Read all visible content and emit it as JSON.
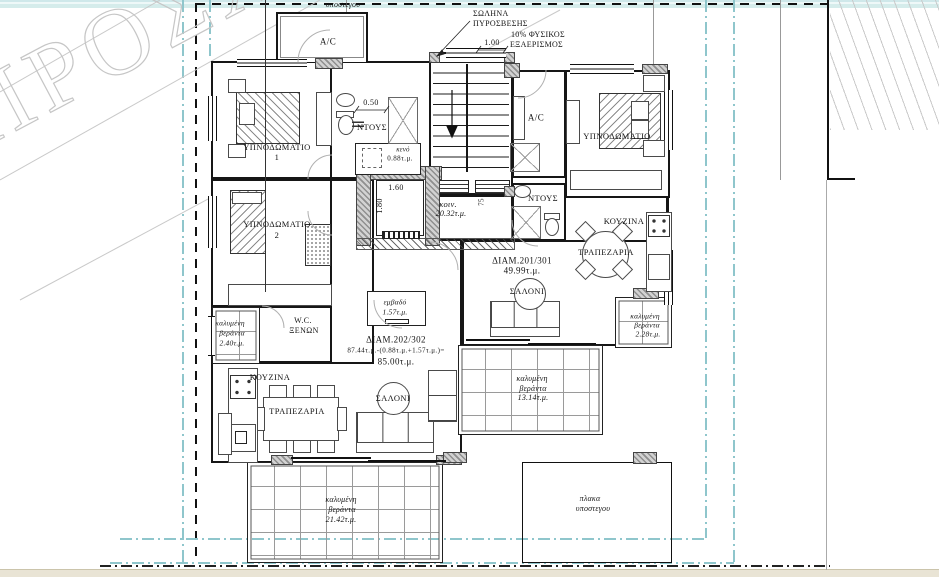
{
  "watermark": {
    "text": "ΠΡΟΣΧΕΔΙΟ"
  },
  "site": {
    "top_shelter_label": "υποστεγου",
    "shelter_slab": {
      "line1": "πλακα",
      "line2": "υποστεγου"
    },
    "fire_pipe": {
      "line1": "ΣΩΛΗΝΑ",
      "line2": "ΠΥΡΟΣΒΕΣΗΣ"
    },
    "ventilation": {
      "dim": "1.00",
      "line1": "10% ΦΥΣΙΚΟΣ",
      "line2": "ΕΞΑΕΡΙΣΜΟΣ"
    }
  },
  "common_areas": {
    "corridor": {
      "name": "κοιν.",
      "area": "20.32τ.μ.",
      "dim": "75"
    },
    "elevator": {
      "width": "1.60",
      "depth": "1.80"
    },
    "void": {
      "name": "κενό",
      "area": "0.88τ.μ."
    },
    "area_box": {
      "name": "εμβαδό",
      "area": "1.57τ.μ."
    }
  },
  "apartment_left": {
    "id": "ΔΙΑΜ.202/302",
    "area_calc": "87.44τ.μ.-(0.88τ.μ.+1.57τ.μ.)=",
    "area_total": "85.00τ.μ.",
    "rooms": {
      "ac": "A/C",
      "bedroom1": {
        "line1": "ΥΠΝΟΔΩΜΑΤΙΟ",
        "line2": "1"
      },
      "bedroom2": {
        "line1": "ΥΠΝΟΔΩΜΑΤΙΟ",
        "line2": "2"
      },
      "shower": "ΝΤΟΥΣ",
      "shower_dim": "0.50",
      "wc": {
        "line1": "W.C.",
        "line2": "ΞΕΝΩΝ"
      },
      "kitchen": "ΚΟΥΖΙΝΑ",
      "dining": "ΤΡΑΠΕΖΑΡΙΑ",
      "living": "ΣΑΛΟΝΙ"
    },
    "verandas": {
      "west": {
        "line1": "καλυμένη",
        "line2": "βεράντα",
        "area": "2.40τ.μ."
      },
      "south": {
        "line1": "καλυμένη",
        "line2": "βεράντα",
        "area": "21.42τ.μ."
      }
    }
  },
  "apartment_right": {
    "id": "ΔΙΑΜ.201/301",
    "area_total": "49.99τ.μ.",
    "rooms": {
      "ac": "A/C",
      "bedroom": "ΥΠΝΟΔΩΜΑΤΙΟ",
      "shower": "ΝΤΟΥΣ",
      "kitchen": "ΚΟΥΖΙΝΑ",
      "dining": "ΤΡΑΠΕΖΑΡΙΑ",
      "living": "ΣΑΛΟΝΙ"
    },
    "verandas": {
      "east": {
        "line1": "καλυμένη",
        "line2": "βεράντα",
        "area": "2.28τ.μ."
      },
      "south": {
        "line1": "καλυμένη",
        "line2": "βεράντα",
        "area": "13.14τ.μ."
      }
    }
  },
  "colors": {
    "line": "#161616",
    "hatch_gray": "#9a9a9a",
    "setback_cyan": "#8fc6cc",
    "band_top": "#d2e9ea",
    "band_bottom": "#e9e4d5",
    "watermark": "#c6c6c6"
  }
}
